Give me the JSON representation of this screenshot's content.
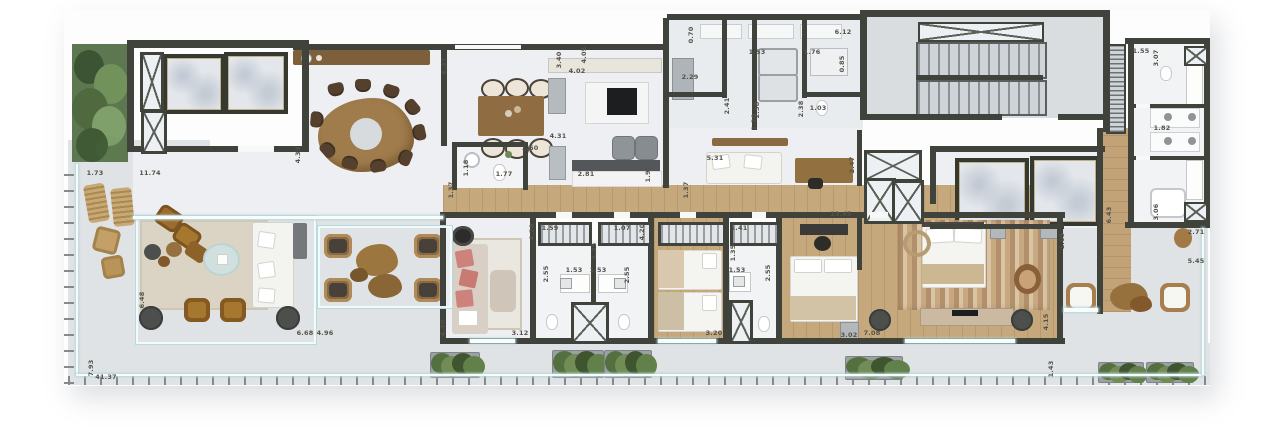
{
  "meta": {
    "type": "architectural-floor-plan",
    "description": "Top-down rendered penthouse apartment floor plan with terrace",
    "units": "meters"
  },
  "palette": {
    "wall": "#3f433b",
    "indoor_floor": "#edeff2",
    "terrace_floor": "#e0e3e5",
    "wood_floor": "#c6a87d",
    "furniture_wood": "#8a6a42",
    "greenery": "#5d7850",
    "coral_sofa": "#cd837c",
    "marble": "#e3e7ec"
  },
  "dimension_labels": [
    {
      "t": "1.73",
      "x": 95,
      "y": 173,
      "v": 0
    },
    {
      "t": "11.74",
      "x": 150,
      "y": 173,
      "v": 0
    },
    {
      "t": "4.33",
      "x": 298,
      "y": 155,
      "v": 1
    },
    {
      "t": "6.37",
      "x": 444,
      "y": 66,
      "v": 1
    },
    {
      "t": "3.40",
      "x": 559,
      "y": 60,
      "v": 1
    },
    {
      "t": "4.05",
      "x": 584,
      "y": 55,
      "v": 1
    },
    {
      "t": "4.02",
      "x": 577,
      "y": 71,
      "v": 0
    },
    {
      "t": "0.70",
      "x": 691,
      "y": 35,
      "v": 1
    },
    {
      "t": "6.12",
      "x": 843,
      "y": 32,
      "v": 0
    },
    {
      "t": "1.53",
      "x": 757,
      "y": 52,
      "v": 0
    },
    {
      "t": "1.76",
      "x": 812,
      "y": 52,
      "v": 0
    },
    {
      "t": "0.85",
      "x": 842,
      "y": 64,
      "v": 1
    },
    {
      "t": "2.29",
      "x": 690,
      "y": 77,
      "v": 0
    },
    {
      "t": "2.41",
      "x": 727,
      "y": 106,
      "v": 1
    },
    {
      "t": "2.38",
      "x": 757,
      "y": 110,
      "v": 1
    },
    {
      "t": "2.38",
      "x": 801,
      "y": 109,
      "v": 1
    },
    {
      "t": "1.03",
      "x": 818,
      "y": 108,
      "v": 0
    },
    {
      "t": "1.20",
      "x": 754,
      "y": 122,
      "v": 1
    },
    {
      "t": "4.31",
      "x": 558,
      "y": 136,
      "v": 0
    },
    {
      "t": "1.60",
      "x": 530,
      "y": 148,
      "v": 0
    },
    {
      "t": "1.18",
      "x": 466,
      "y": 168,
      "v": 1
    },
    {
      "t": "1.77",
      "x": 504,
      "y": 174,
      "v": 0
    },
    {
      "t": "2.81",
      "x": 586,
      "y": 174,
      "v": 0
    },
    {
      "t": "1.92",
      "x": 648,
      "y": 174,
      "v": 1
    },
    {
      "t": "1.37",
      "x": 451,
      "y": 190,
      "v": 1
    },
    {
      "t": "1.37",
      "x": 686,
      "y": 190,
      "v": 1
    },
    {
      "t": "5.31",
      "x": 715,
      "y": 158,
      "v": 0
    },
    {
      "t": "2.47",
      "x": 852,
      "y": 165,
      "v": 1
    },
    {
      "t": "1.55",
      "x": 1141,
      "y": 51,
      "v": 0
    },
    {
      "t": "3.07",
      "x": 1156,
      "y": 58,
      "v": 1
    },
    {
      "t": "1.82",
      "x": 1162,
      "y": 128,
      "v": 0
    },
    {
      "t": "3.06",
      "x": 1156,
      "y": 212,
      "v": 1
    },
    {
      "t": "6.43",
      "x": 1109,
      "y": 215,
      "v": 1
    },
    {
      "t": "1.09",
      "x": 1062,
      "y": 241,
      "v": 1
    },
    {
      "t": "2.71",
      "x": 1196,
      "y": 232,
      "v": 0
    },
    {
      "t": "5.45",
      "x": 1196,
      "y": 261,
      "v": 0
    },
    {
      "t": "13.45",
      "x": 841,
      "y": 214,
      "v": 0
    },
    {
      "t": "3.02",
      "x": 849,
      "y": 335,
      "v": 0
    },
    {
      "t": "7.08",
      "x": 872,
      "y": 333,
      "v": 0
    },
    {
      "t": "4.15",
      "x": 1046,
      "y": 322,
      "v": 1
    },
    {
      "t": "1.43",
      "x": 1051,
      "y": 369,
      "v": 1
    },
    {
      "t": "4.40",
      "x": 443,
      "y": 328,
      "v": 1
    },
    {
      "t": "3.12",
      "x": 520,
      "y": 333,
      "v": 0
    },
    {
      "t": "4.20",
      "x": 532,
      "y": 232,
      "v": 1
    },
    {
      "t": "1.59",
      "x": 550,
      "y": 228,
      "v": 0
    },
    {
      "t": "1.07",
      "x": 622,
      "y": 228,
      "v": 0
    },
    {
      "t": "1.35",
      "x": 594,
      "y": 251,
      "v": 1
    },
    {
      "t": "1.53",
      "x": 574,
      "y": 270,
      "v": 0
    },
    {
      "t": "1.53",
      "x": 598,
      "y": 270,
      "v": 0
    },
    {
      "t": "2.55",
      "x": 546,
      "y": 274,
      "v": 1
    },
    {
      "t": "2.55",
      "x": 627,
      "y": 275,
      "v": 1
    },
    {
      "t": "4.20",
      "x": 642,
      "y": 232,
      "v": 1
    },
    {
      "t": "1.41",
      "x": 739,
      "y": 228,
      "v": 0
    },
    {
      "t": "1.35",
      "x": 733,
      "y": 253,
      "v": 1
    },
    {
      "t": "1.53",
      "x": 737,
      "y": 270,
      "v": 0
    },
    {
      "t": "2.55",
      "x": 768,
      "y": 273,
      "v": 1
    },
    {
      "t": "3.20",
      "x": 714,
      "y": 333,
      "v": 0
    },
    {
      "t": "6.48",
      "x": 142,
      "y": 300,
      "v": 1
    },
    {
      "t": "6.68",
      "x": 305,
      "y": 333,
      "v": 0
    },
    {
      "t": "4.96",
      "x": 325,
      "y": 333,
      "v": 0
    },
    {
      "t": "7.93",
      "x": 91,
      "y": 368,
      "v": 1
    },
    {
      "t": "41.37",
      "x": 106,
      "y": 377,
      "v": 0
    }
  ]
}
